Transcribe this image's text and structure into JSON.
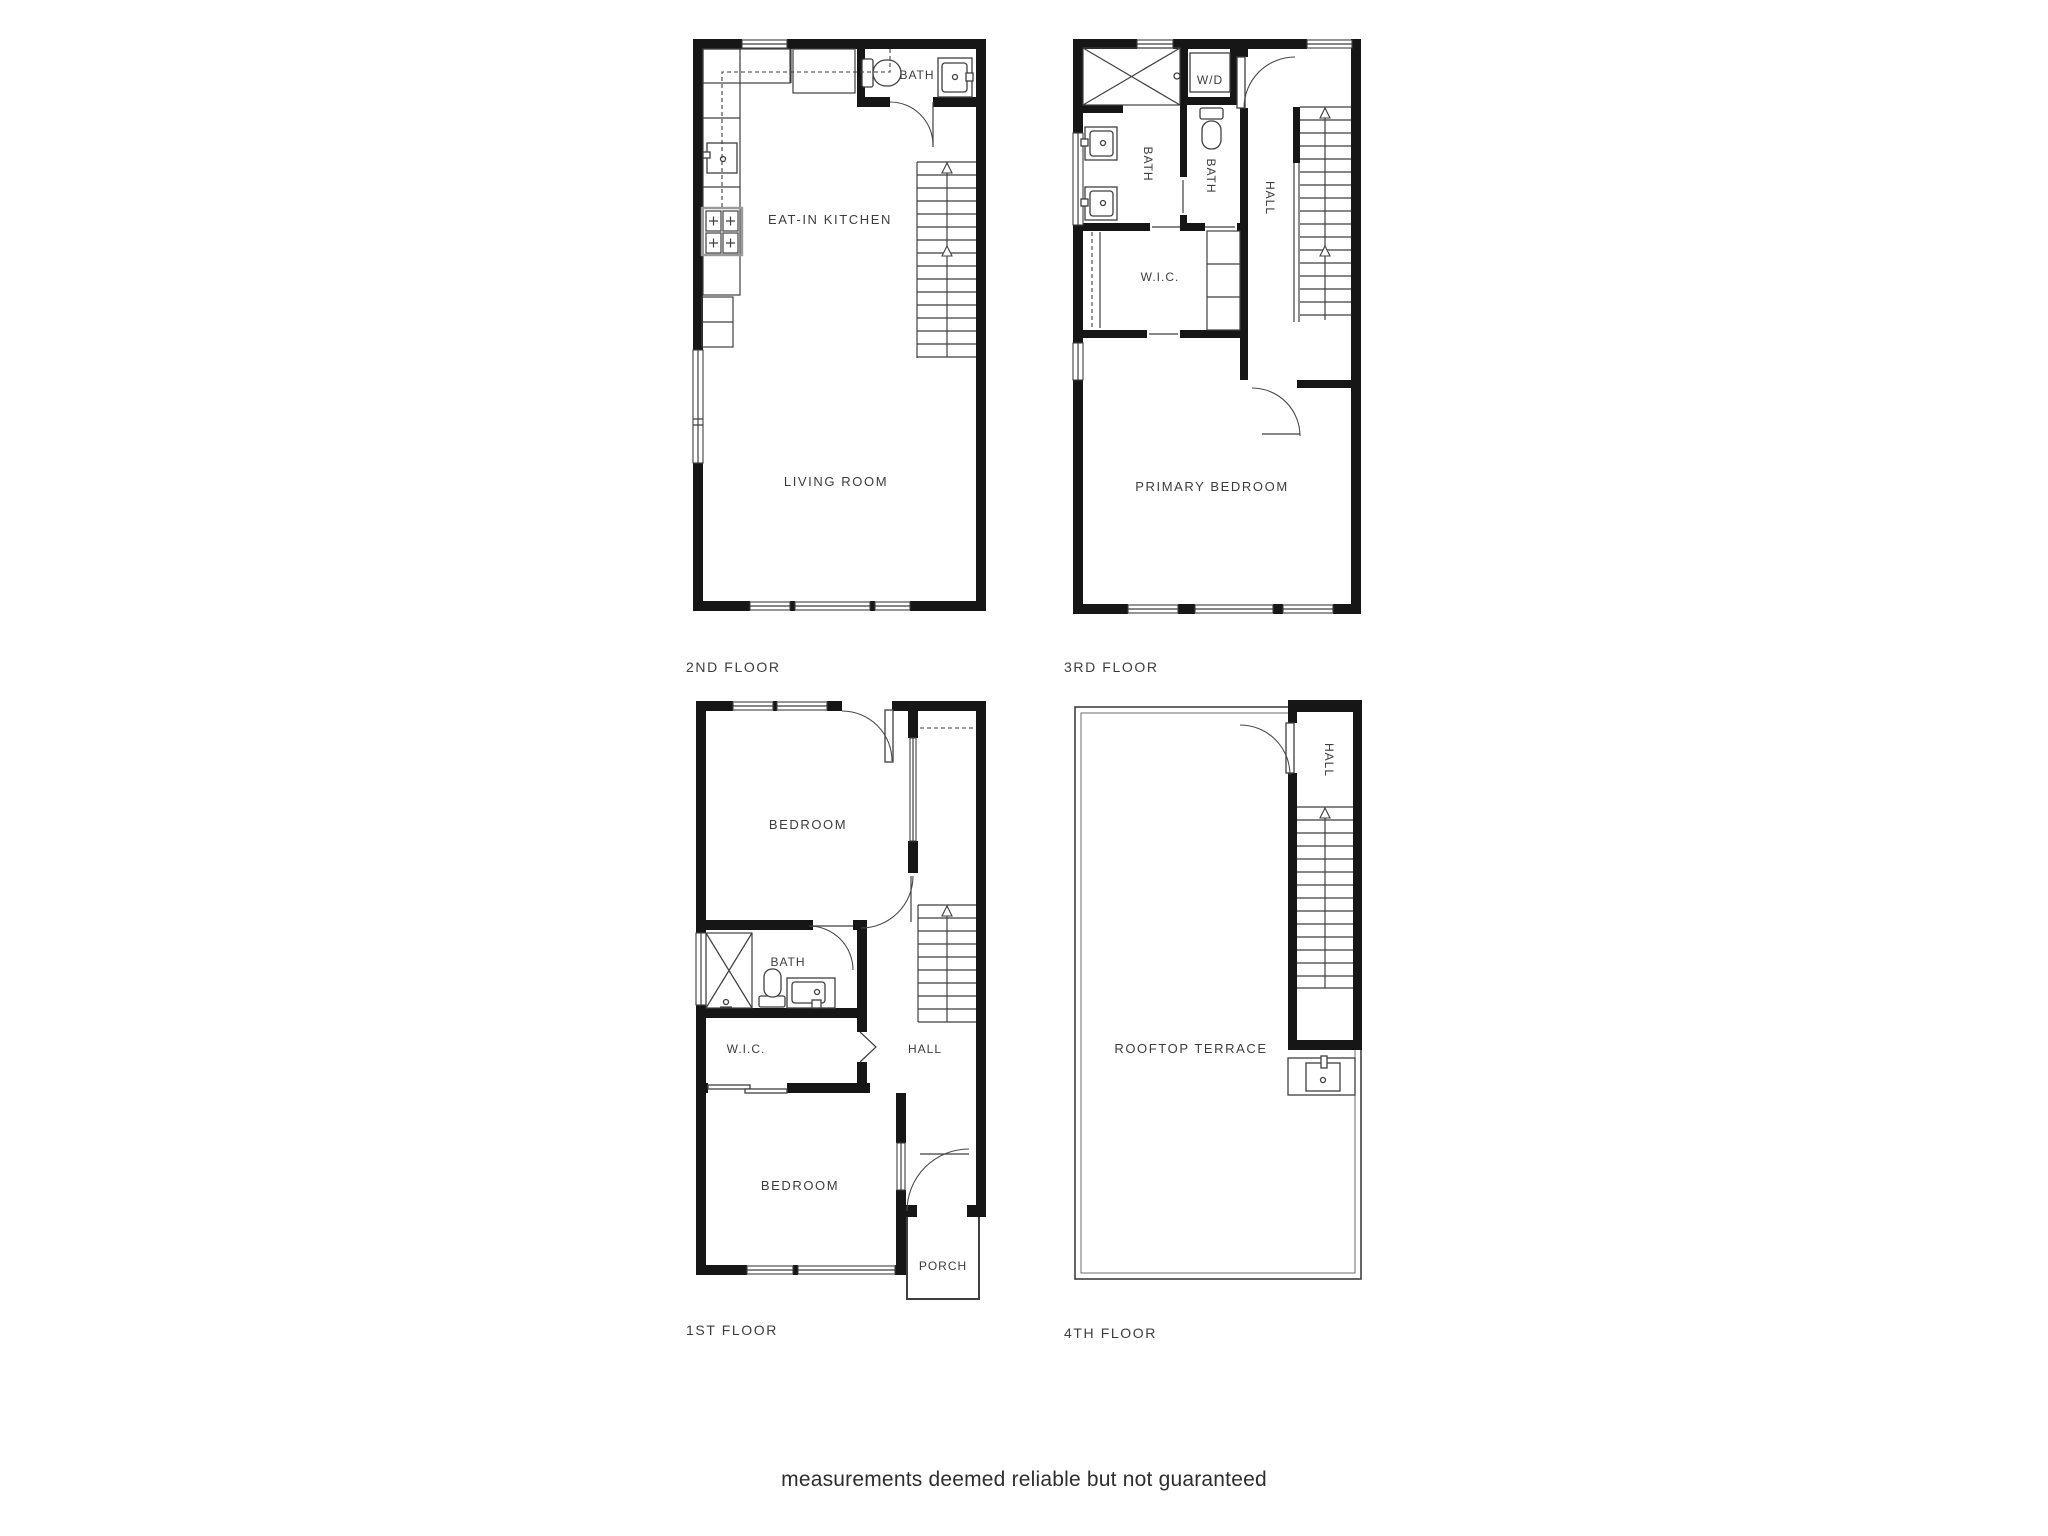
{
  "floors": {
    "second": {
      "label": "2ND FLOOR",
      "rooms": {
        "bath": "BATH",
        "kitchen": "EAT-IN KITCHEN",
        "living": "LIVING ROOM"
      }
    },
    "third": {
      "label": "3RD FLOOR",
      "rooms": {
        "wd": "W/D",
        "bath_left": "BATH",
        "bath_mid": "BATH",
        "hall": "HALL",
        "wic": "W.I.C.",
        "primary": "PRIMARY BEDROOM"
      }
    },
    "first": {
      "label": "1ST FLOOR",
      "rooms": {
        "bedroom_top": "BEDROOM",
        "bath": "BATH",
        "wic": "W.I.C.",
        "hall": "HALL",
        "bedroom_bottom": "BEDROOM",
        "porch": "PORCH"
      }
    },
    "fourth": {
      "label": "4TH FLOOR",
      "rooms": {
        "hall": "HALL",
        "terrace": "ROOFTOP TERRACE"
      }
    }
  },
  "footer": {
    "disclaimer": "measurements deemed reliable but not guaranteed"
  },
  "colors": {
    "wall": "#161616",
    "line": "#3f3f3f",
    "label": "#3d3d3d",
    "disclaimer": "#2e2e2e"
  }
}
